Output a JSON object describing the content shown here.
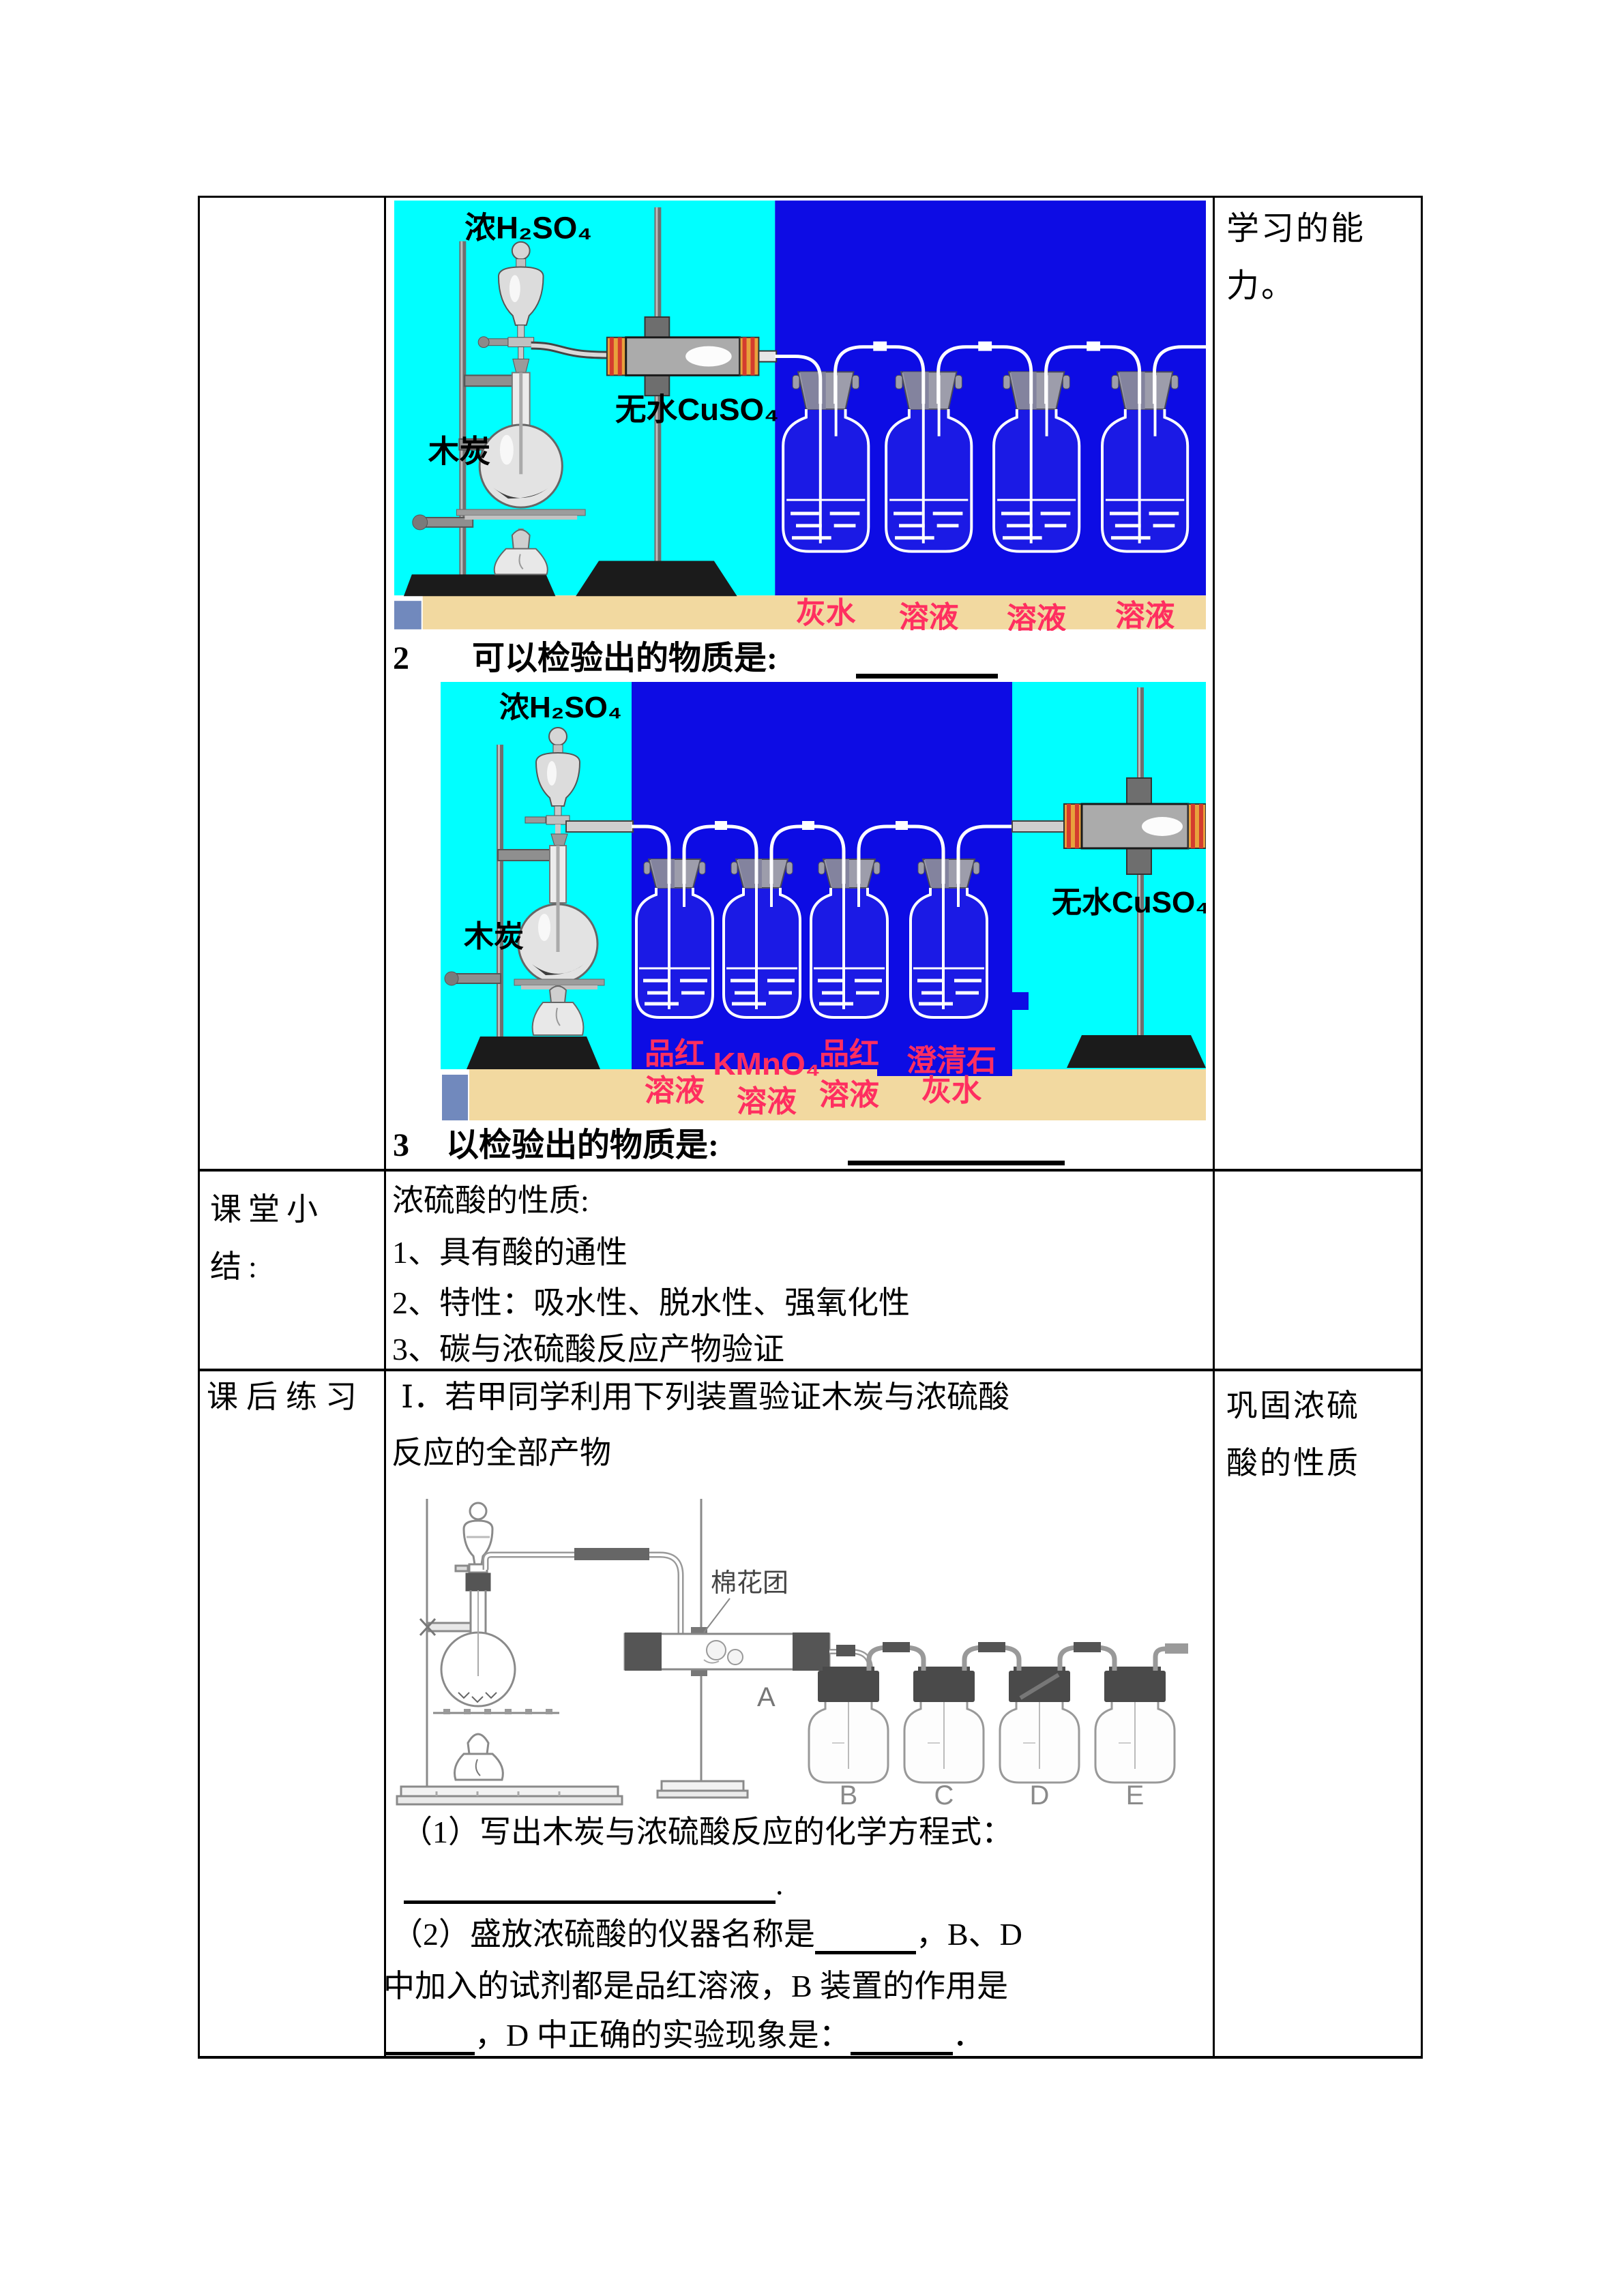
{
  "colors": {
    "cyan": "#00ffff",
    "blue": "#0d0ce4",
    "tan": "#f2d9a0",
    "slate_square": "#7189bd",
    "label_pink": "#ff2e60",
    "table_border": "#000000"
  },
  "row1": {
    "right_text": "学习的能力。",
    "q2": {
      "num": "2",
      "label": "可以检验出的物质是:"
    },
    "q3": {
      "num": "3",
      "label": "以检验出的物质是:"
    }
  },
  "img1": {
    "acid": "浓H₂SO₄",
    "charcoal": "木炭",
    "tube": "无水CuSO₄",
    "bottles": [
      {
        "top": "澄清石",
        "bottom": "灰水"
      },
      {
        "top": "品红",
        "bottom": "溶液"
      },
      {
        "top": "KMnO₄",
        "bottom": "溶液"
      },
      {
        "top": "品红",
        "bottom": "溶液"
      }
    ]
  },
  "img2": {
    "acid": "浓H₂SO₄",
    "charcoal": "木炭",
    "tube": "无水CuSO₄",
    "bottles": [
      {
        "top": "品红",
        "bottom": "溶液"
      },
      {
        "top": "KMnO₄",
        "bottom": "溶液"
      },
      {
        "top": "品红",
        "bottom": "溶液"
      },
      {
        "top": "澄清石",
        "bottom": "灰水"
      }
    ]
  },
  "row2": {
    "left": "课堂小结:",
    "lines": [
      "浓硫酸的性质:",
      "1、具有酸的通性",
      "2、特性：吸水性、脱水性、强氧化性",
      "3、碳与浓硫酸反应产物验证"
    ]
  },
  "row3": {
    "left": "课后练习",
    "right": "巩固浓硫酸的性质",
    "intro1": "Ⅰ．若甲同学利用下列装置验证木炭与浓硫酸",
    "intro2": "反应的全部产物",
    "img3": {
      "cotton": "棉花团",
      "tube_label": "A",
      "bottle_labels": [
        "B",
        "C",
        "D",
        "E"
      ]
    },
    "q1": "（1）写出木炭与浓硫酸反应的化学方程式：",
    "q1_tail": ".",
    "q2_pre": "（2）盛放浓硫酸的仪器名称是",
    "q2_mid": "，B、D",
    "q3_line": "中加入的试剂都是品红溶液，B 装置的作用是",
    "q4_mid": "，D 中正确的实验现象是：",
    "q4_tail": "．"
  }
}
